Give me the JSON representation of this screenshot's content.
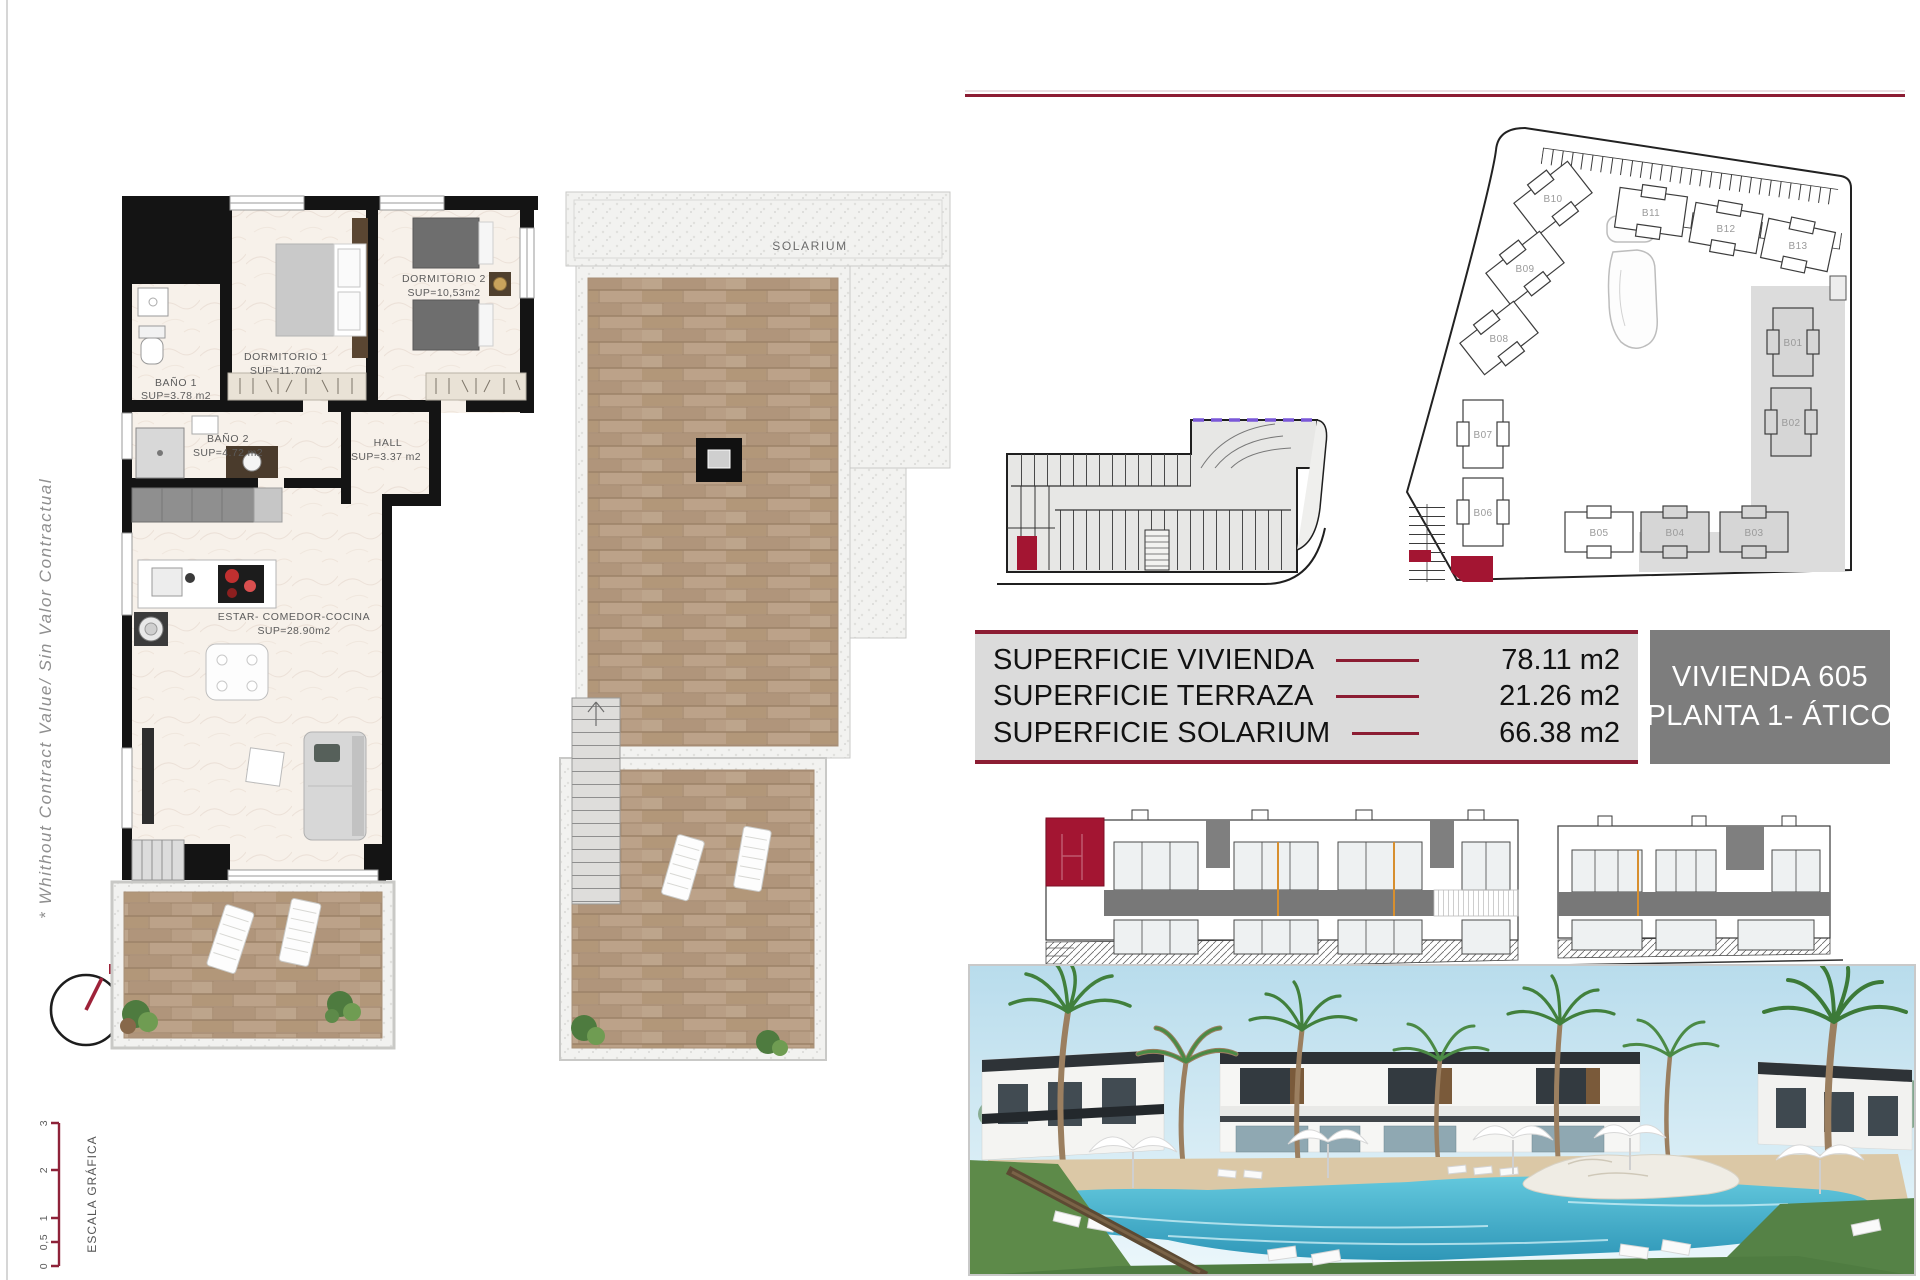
{
  "document": {
    "side_note": "* Whithout Contract Value/ Sin Valor Contractual",
    "compass": {
      "north": "N"
    },
    "scale_bar": {
      "title": "ESCALA GRÁFICA",
      "ticks": [
        "0",
        "0,5",
        "1",
        "2",
        "3"
      ]
    }
  },
  "apartment_plan": {
    "rooms": [
      {
        "name": "DORMITORIO 1",
        "area": "SUP=11.70m2"
      },
      {
        "name": "DORMITORIO 2",
        "area": "SUP=10,53m2"
      },
      {
        "name": "BAÑO 1",
        "area": "SUP=3.78 m2"
      },
      {
        "name": "BAÑO 2",
        "area": "SUP=4.72 m2"
      },
      {
        "name": "HALL",
        "area": "SUP=3.37 m2"
      },
      {
        "name": "ESTAR- COMEDOR-COCINA",
        "area": "SUP=28.90m2"
      }
    ]
  },
  "solarium_plan": {
    "label": "SOLARIUM"
  },
  "site_plan": {
    "buildings": [
      {
        "id": "B01"
      },
      {
        "id": "B02"
      },
      {
        "id": "B03"
      },
      {
        "id": "B04"
      },
      {
        "id": "B05"
      },
      {
        "id": "B06"
      },
      {
        "id": "B07"
      },
      {
        "id": "B08"
      },
      {
        "id": "B09"
      },
      {
        "id": "B10"
      },
      {
        "id": "B11"
      },
      {
        "id": "B12"
      },
      {
        "id": "B13"
      }
    ]
  },
  "summary": {
    "rows": [
      {
        "label": "SUPERFICIE VIVIENDA",
        "value": "78.11 m2"
      },
      {
        "label": "SUPERFICIE TERRAZA",
        "value": "21.26 m2"
      },
      {
        "label": "SUPERFICIE SOLARIUM",
        "value": "66.38 m2"
      }
    ],
    "unit": {
      "name": "VIVIENDA 605",
      "floor": "PLANTA 1- ÁTICO"
    }
  },
  "colors": {
    "accent_maroon": "#8c1d33",
    "highlight_red": "#a31532",
    "table_bg": "#dbdbdb",
    "unit_box_bg": "#7d7d7d",
    "ramp_dash_purple": "#7a58d8",
    "deck_wood": "#b79d84"
  }
}
